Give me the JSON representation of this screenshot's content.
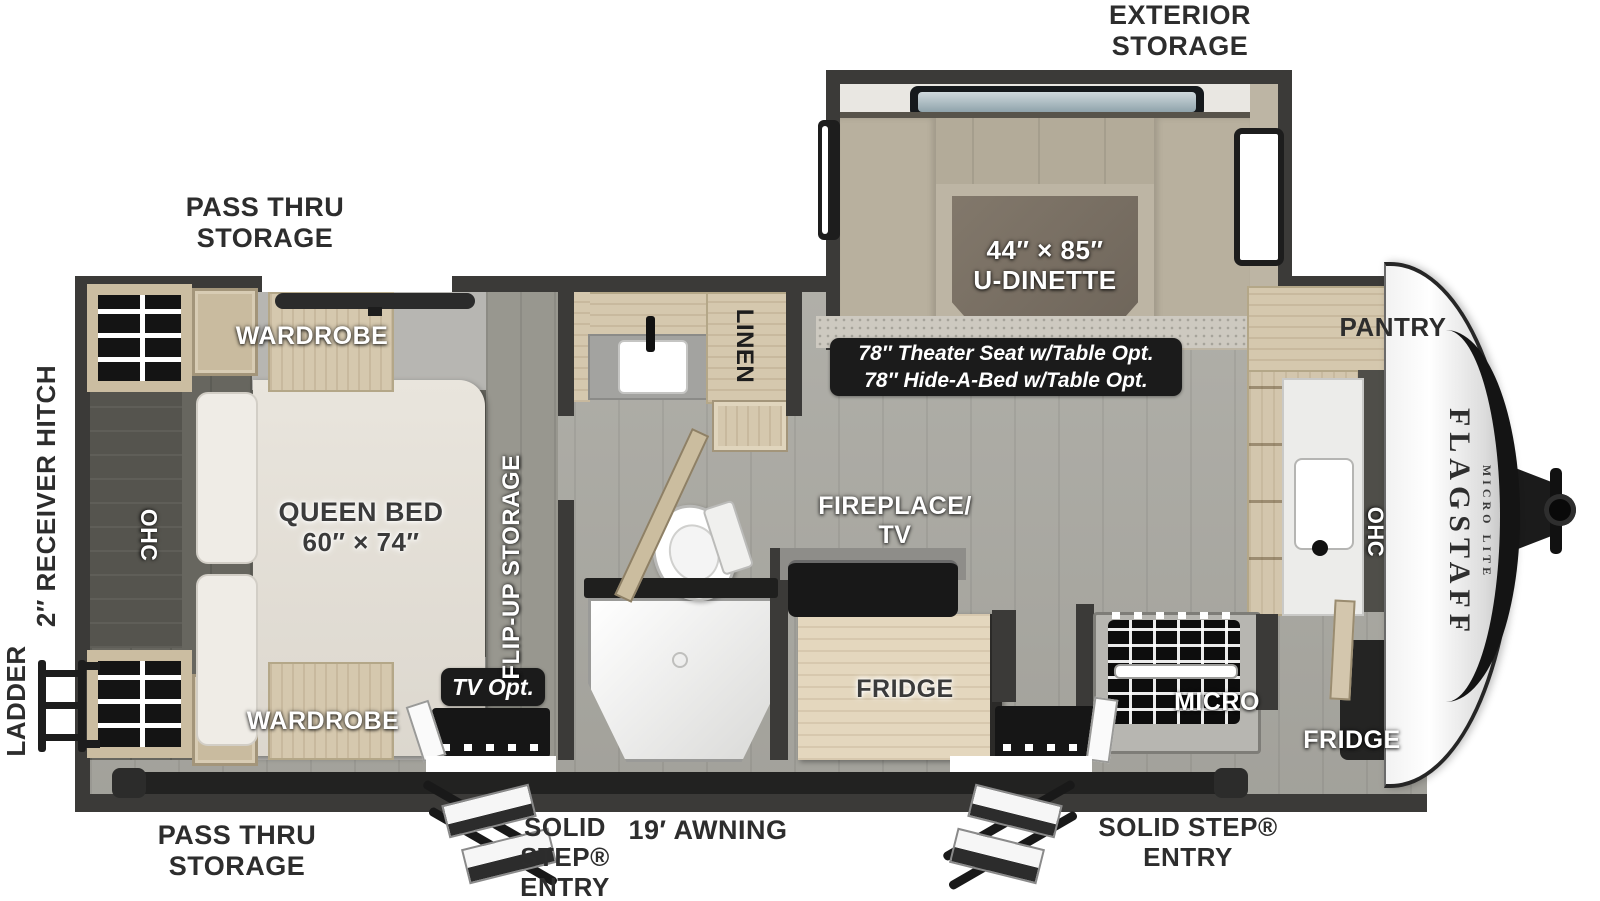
{
  "colors": {
    "wall": "#3b3a38",
    "wood": "#d5c8ae",
    "floor": "#abaaa3",
    "carpet": "#cdc9c0",
    "badge_bg": "#1b1b1b",
    "label_dark": "#2d2d2d",
    "label_white": "#ffffff"
  },
  "brand": {
    "name": "FLAGSTAFF",
    "series": "MICRO LITE"
  },
  "exterior": {
    "exterior_storage": "EXTERIOR STORAGE",
    "pass_thru_storage_top": "PASS THRU STORAGE",
    "pass_thru_storage_bottom": "PASS THRU STORAGE",
    "ladder": "LADDER",
    "receiver_hitch": "2″ RECEIVER HITCH",
    "awning": "19′ AWNING",
    "solid_step_entry_left": "SOLID STEP® ENTRY",
    "solid_step_entry_right": "SOLID STEP® ENTRY"
  },
  "bedroom": {
    "queen_bed_line1": "QUEEN BED",
    "queen_bed_line2": "60″ × 74″",
    "wardrobe_top": "WARDROBE",
    "wardrobe_bottom": "WARDROBE",
    "overhead_cabinet": "OHC",
    "flip_up_storage": "FLIP-UP STORAGE",
    "tv_option": "TV Opt."
  },
  "bathroom": {
    "linen": "LINEN"
  },
  "living_area": {
    "dinette_size": "44″ × 85″",
    "dinette_name": "U-DINETTE",
    "option_line1": "78″ Theater Seat w/Table Opt.",
    "option_line2": "78″ Hide-A-Bed w/Table Opt.",
    "fireplace_line1": "FIREPLACE/",
    "fireplace_line2": "TV",
    "fridge": "FRIDGE"
  },
  "kitchen": {
    "pantry": "PANTRY",
    "overhead_cabinet": "OHC",
    "micro": "MICRO",
    "fridge": "FRIDGE"
  }
}
